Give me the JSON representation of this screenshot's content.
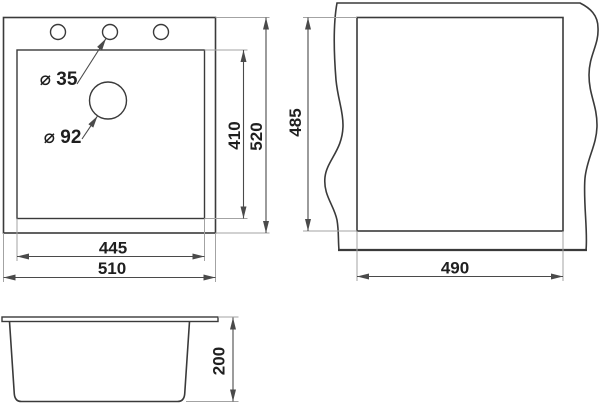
{
  "drawing": {
    "top_view": {
      "faucet_hole_label": "⌀ 35",
      "drain_hole_label": "⌀ 92",
      "bowl_length": "410",
      "overall_length": "520",
      "bowl_width": "445",
      "overall_width": "510"
    },
    "cutout_view": {
      "cutout_length": "485",
      "cutout_width": "490"
    },
    "side_view": {
      "depth": "200"
    },
    "colors": {
      "object_line": "#3a3a3a",
      "dimension_line": "#4a4a4a",
      "extension_line": "#a3a3a3",
      "text": "#1f1f1f",
      "background": "#ffffff"
    }
  }
}
